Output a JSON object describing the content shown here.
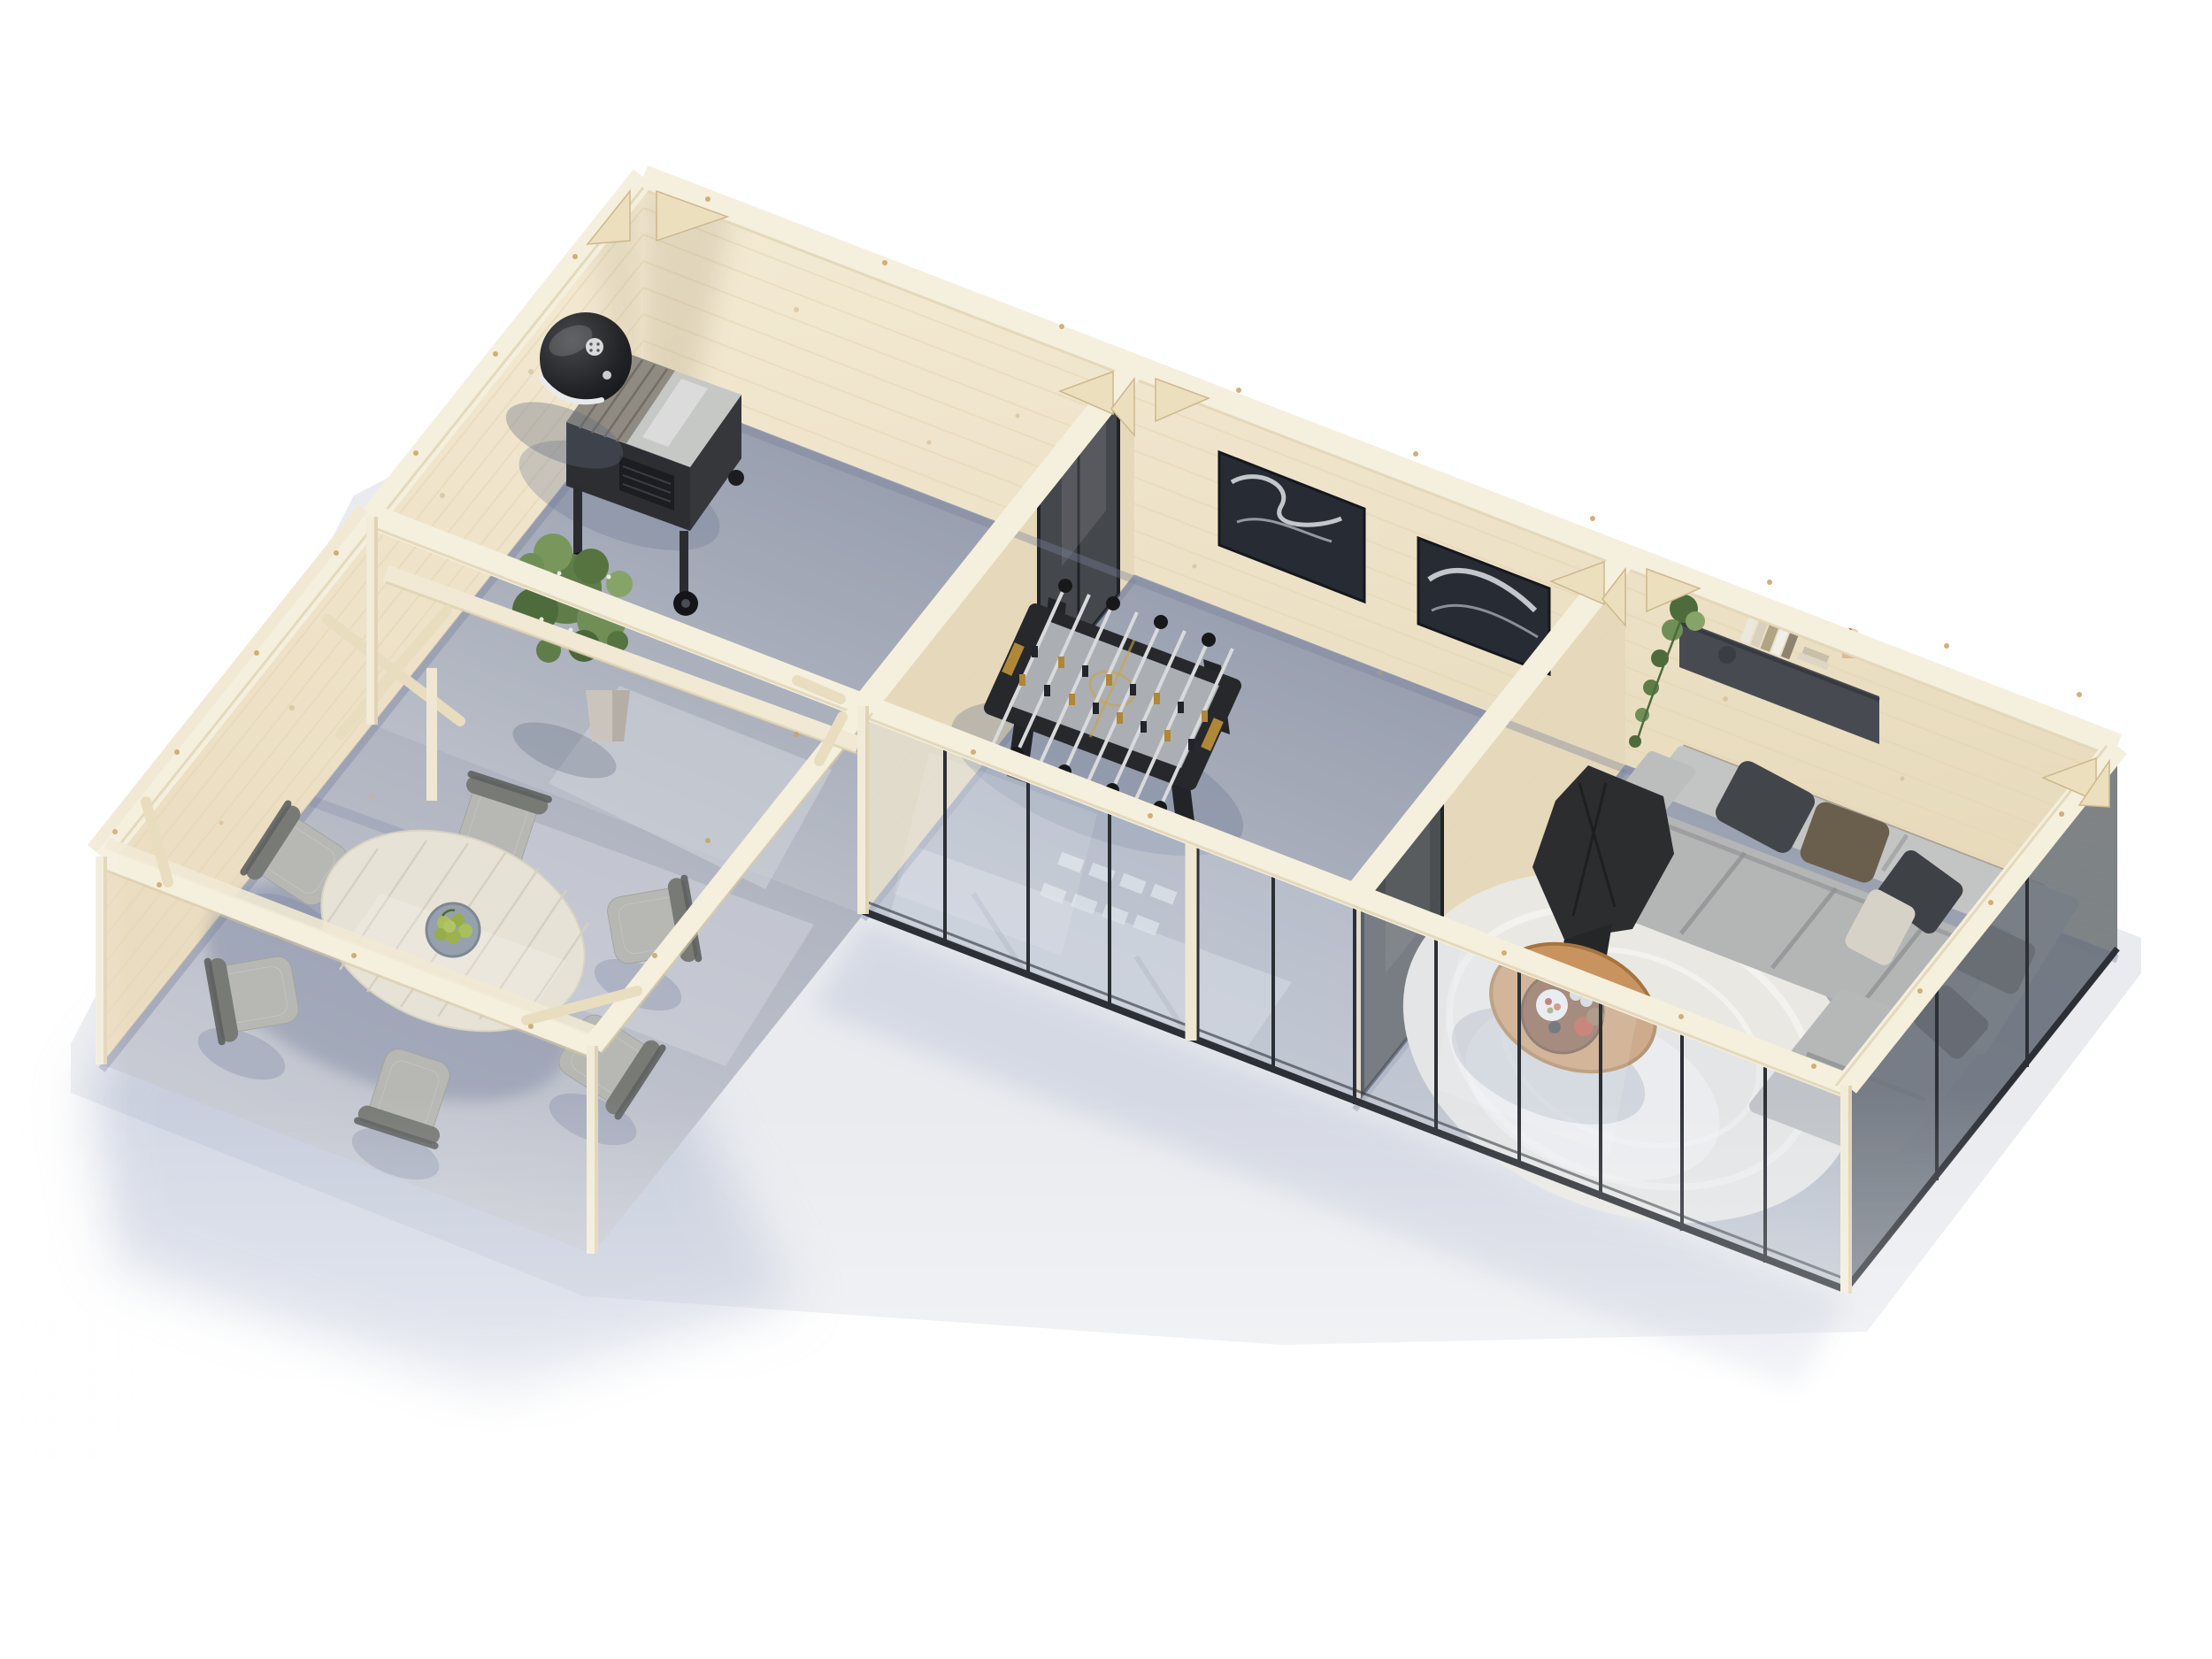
{
  "scene": {
    "label": "Aerial 3D cutaway render of an L-shaped wooden garden building with open pergola dining area",
    "view": "top-down bird's eye, rotated",
    "background": "#ffffff"
  },
  "palette": {
    "wood": "#f1e7cf",
    "woodLight": "#f5efdd",
    "woodGlare": "#fbf8ee",
    "woodDark": "#e6d9bb",
    "woodEdge": "#d9c9a6",
    "grain": "#e3d5b4",
    "knot": "#cfb287",
    "floorDark": "#949bac",
    "floorMid": "#aeb3bf",
    "floorLight": "#cfd3da",
    "slab": "#e9ebef",
    "shadow": "#a9b3cc",
    "contact": "#79809a",
    "frame": "#2c3036",
    "frameDark": "#1f2328",
    "glass": "#d7dfeb",
    "sofa": "#b4b5b5",
    "sofaLight": "#c3c4c4",
    "sofaShade": "#98999a",
    "pillowDark": "#42454a",
    "pillowBrown": "#6a5f4c",
    "pillowCream": "#d6d2c8",
    "throw": "#2b2d2f",
    "rug": "#e9e8e3",
    "rugRing": "#f5f4f0",
    "tableTop": "#c9935f",
    "tray": "#7d4f33",
    "black": "#26282b",
    "metal": "#c6c8c6",
    "slat": "#8f8a82",
    "green1": "#5f7d49",
    "green2": "#6f8f57",
    "green3": "#4e6b3c",
    "green4": "#86a468",
    "pear": "#a9bf5b",
    "chairSeat": "#b7b8b4",
    "chairFrame": "#787a76",
    "chairFrameDark": "#5d605f",
    "dineTop": "#e7e2d6",
    "art": "#272c34",
    "artSwirl": "#dfe3e8",
    "shelf": "#474b51",
    "gold": "#b08734",
    "pot": "#cbc4bd"
  },
  "building": {
    "label": "L-shaped log garden room, pale spruce walls, glazed front, concrete slab",
    "wall_material": "untreated pale spruce logs",
    "glazing": "full-height panels with dark aluminium frames"
  },
  "rooms": [
    {
      "id": "bbq-room",
      "label": "BBQ room with kettle grill, grill cart and potted plant"
    },
    {
      "id": "games-room",
      "label": "Games room with foosball table, two abstract artworks and sliding glass door"
    },
    {
      "id": "lounge",
      "label": "Lounge with modular sofa, cushions, black throw, round rug, coffee table and wall shelf"
    },
    {
      "id": "pergola-dining",
      "label": "Open pergola dining area with round table, six chairs and bowl of pears"
    }
  ],
  "objects": {
    "grill": {
      "label": "black kettle grill"
    },
    "grillCart": {
      "label": "grill cart with stainless lid"
    },
    "plantBBQ": {
      "label": "green potted plant"
    },
    "foosball": {
      "label": "black foosball table with eight rods"
    },
    "art1": {
      "label": "abstract black and white artwork"
    },
    "art2": {
      "label": "abstract black and white artwork"
    },
    "shelfUnit": {
      "label": "dark wall shelf with books, trailing plant and candle"
    },
    "sofa": {
      "label": "light grey modular corner sofa"
    },
    "rug": {
      "label": "round ivory rug"
    },
    "coffeeTable": {
      "label": "round wooden coffee table with serving tray"
    },
    "diningTable": {
      "label": "round whitewashed dining table"
    },
    "diningChairs": {
      "label": "six grey dining chairs",
      "count": 6
    },
    "fruitBowl": {
      "label": "bowl of green pears"
    }
  }
}
